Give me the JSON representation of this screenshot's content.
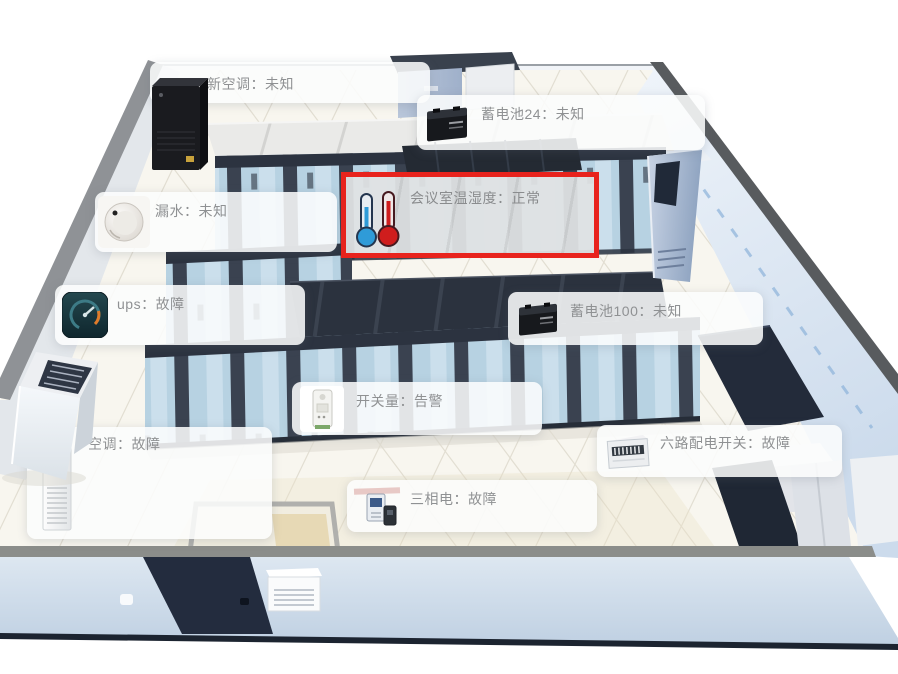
{
  "scene_description": "3D server room monitoring view",
  "colors": {
    "highlight_red": "#e8231d",
    "thermometer_blue": "#2f9bd8",
    "thermometer_red": "#cf1d1d",
    "label_text": "#8f9193"
  },
  "devices": [
    {
      "name": "新空调",
      "status": "未知",
      "label": "新空调：未知",
      "icon": "none"
    },
    {
      "name": "蓄电池24",
      "status": "未知",
      "label": "蓄电池24：未知",
      "icon": "battery-icon"
    },
    {
      "name": "会议室温湿度",
      "status": "正常",
      "label": "会议室温湿度：正常",
      "icon": "thermometer-icons",
      "highlighted": true
    },
    {
      "name": "漏水",
      "status": "未知",
      "label": "漏水：未知",
      "icon": "water-sensor-icon"
    },
    {
      "name": "ups",
      "status": "故障",
      "label": "ups：故障",
      "icon": "gauge-icon"
    },
    {
      "name": "蓄电池100",
      "status": "未知",
      "label": "蓄电池100：未知",
      "icon": "battery-icon"
    },
    {
      "name": "开关量",
      "status": "告警",
      "label": "开关量：告警",
      "icon": "switch-sensor-icon"
    },
    {
      "name": "空调",
      "status": "故障",
      "label": "空调：故障",
      "icon": "floor-ac-icon"
    },
    {
      "name": "六路配电开关",
      "status": "故障",
      "label": "六路配电开关：故障",
      "icon": "distribution-box-icon"
    },
    {
      "name": "三相电",
      "status": "故障",
      "label": "三相电：故障",
      "icon": "power-meter-icon"
    }
  ]
}
